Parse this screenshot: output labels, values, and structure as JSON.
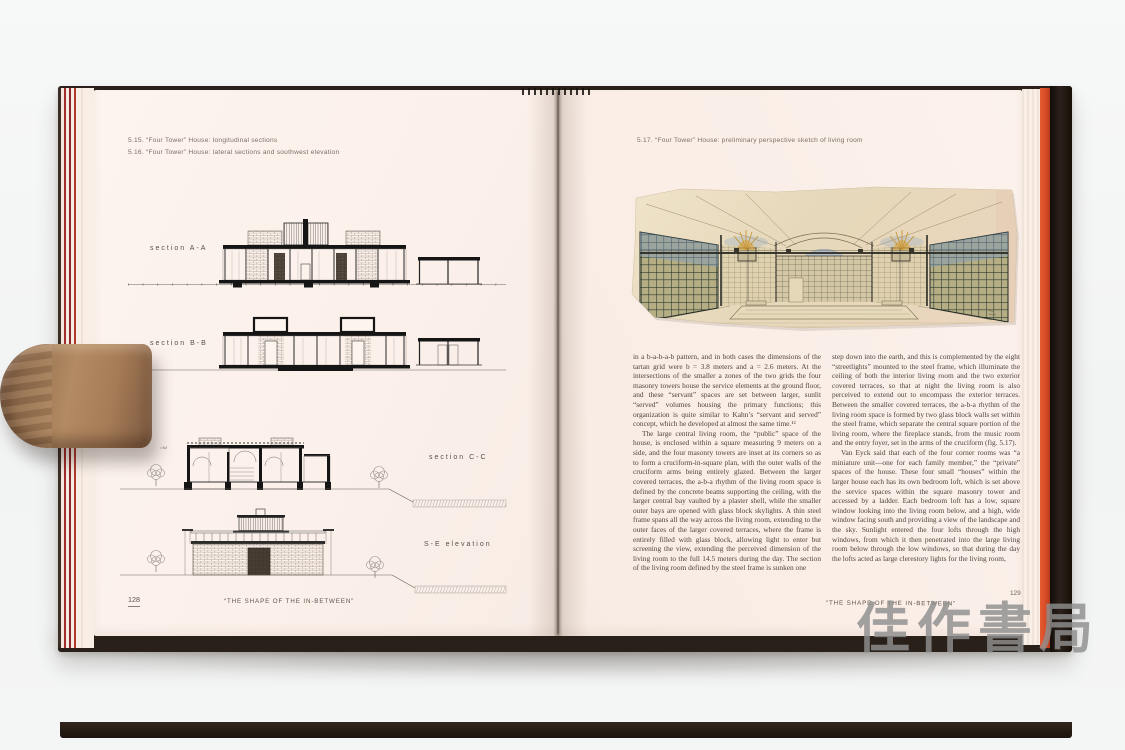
{
  "photo": {
    "watermark_text": "佳作書局",
    "background_color": "#f3f4f4"
  },
  "book": {
    "cover_color": "#261c16",
    "page_color": "#fbf0ea",
    "edge_stripe_red": "#9c2b2b",
    "endpaper_orange": "#d94f2b",
    "left_page": {
      "captions": [
        "5.15. “Four Tower” House: longitudinal sections",
        "5.16. “Four Tower” House: lateral sections and southwest elevation"
      ],
      "drawings": [
        {
          "label": "section A-A"
        },
        {
          "label": "section B-B"
        },
        {
          "label": "section C-C"
        },
        {
          "label": "S-E elevation"
        }
      ],
      "level_note": "240 +",
      "page_number": "128",
      "running_footer": "“THE SHAPE OF THE IN-BETWEEN”"
    },
    "right_page": {
      "caption": "5.17. “Four Tower” House: preliminary perspective sketch of living room",
      "columns": [
        {
          "paragraphs": [
            "in a b-a-b-a-b pattern, and in both cases the dimensions of the tartan grid were b = 3.8 meters and a = 2.6 meters. At the intersections of the smaller a zones of the two grids the four masonry towers house the service elements at the ground floor, and these “servant” spaces are set between larger, sunlit “served” volumes housing the primary functions; this organization is quite similar to Kahn’s “servant and served” concept, which he developed at almost the same time.¹²",
            "The large central living room, the “public” space of the house, is enclosed within a square measuring 9 meters on a side, and the four masonry towers are inset at its corners so as to form a cruciform-in-square plan, with the outer walls of the cruciform arms being entirely glazed. Between the larger covered terraces, the a-b-a rhythm of the living room space is defined by the concrete beams supporting the ceiling, with the larger central bay vaulted by a plaster shell, while the smaller outer bays are opened with glass block skylights. A thin steel frame spans all the way across the living room, extending to the outer faces of the larger covered terraces, where the frame is entirely filled with glass block, allowing light to enter but screening the view, extending the perceived dimension of the living room to the full 14.5 meters during the day. The section of the living room defined by the steel frame is sunken one"
          ]
        },
        {
          "paragraphs": [
            "step down into the earth, and this is complemented by the eight “streetlights” mounted to the steel frame, which illuminate the ceiling of both the interior living room and the two exterior covered terraces, so that at night the living room is also perceived to extend out to encompass the exterior terraces. Between the smaller covered terraces, the a-b-a rhythm of the living room space is formed by two glass block walls set within the steel frame, which separate the central square portion of the living room, where the fireplace stands, from the music room and the entry foyer, set in the arms of the cruciform (fig. 5.17).",
            "Van Eyck said that each of the four corner rooms was “a miniature unit—one for each family member,” the “private” spaces of the house. These four small “houses” within the larger house each has its own bedroom loft, which is set above the service spaces within the square masonry tower and accessed by a ladder. Each bedroom loft has a low, square window looking into the living room below, and a high, wide window facing south and providing a view of the landscape and the sky. Sunlight entered the four lofts through the high windows, from which it then penetrated into the large living room below through the low windows, so that during the day the lofts acted as large clerestory lights for the living room,"
          ]
        }
      ],
      "page_number": "129",
      "running_footer": "“THE SHAPE OF THE IN-BETWEEN”"
    }
  }
}
